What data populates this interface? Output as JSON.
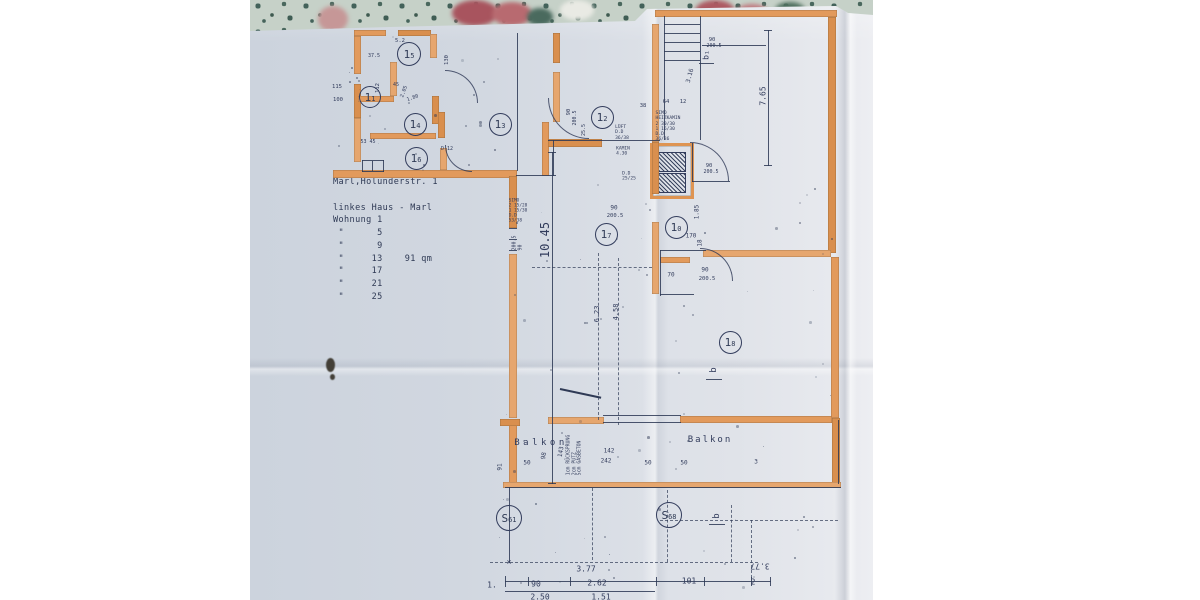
{
  "photo": {
    "description": "photo of an architectural floor plan on floral fabric",
    "address_block": "Marl,Holunderstr. 1\n\nlinkes Haus - Marl\nWohnung 1\n \"      5\n \"      9\n \"     13    91 qm\n \"     17\n \"     21\n \"     25",
    "badges": [
      {
        "m": "1",
        "s": "5",
        "x": 408,
        "y": 53,
        "d": 22
      },
      {
        "m": "1",
        "s": "1",
        "x": 369,
        "y": 96,
        "d": 20
      },
      {
        "m": "1",
        "s": "4",
        "x": 414,
        "y": 123,
        "d": 21
      },
      {
        "m": "1",
        "s": "3",
        "x": 499,
        "y": 123,
        "d": 21
      },
      {
        "m": "1",
        "s": "6",
        "x": 415,
        "y": 157,
        "d": 21
      },
      {
        "m": "1",
        "s": "2",
        "x": 601,
        "y": 116,
        "d": 21
      },
      {
        "m": "1",
        "s": "7",
        "x": 605,
        "y": 233,
        "d": 21
      },
      {
        "m": "1",
        "s": "0",
        "x": 675,
        "y": 226,
        "d": 21
      },
      {
        "m": "1",
        "s": "8",
        "x": 729,
        "y": 341,
        "d": 21
      },
      {
        "m": "S",
        "s": "61",
        "x": 508,
        "y": 517,
        "d": 24
      },
      {
        "m": "S",
        "s": "68",
        "x": 668,
        "y": 514,
        "d": 24
      }
    ],
    "labels": [
      {
        "t": "Balkon",
        "x": 541,
        "y": 443,
        "s": 9,
        "ls": 3.5
      },
      {
        "t": "Balkon",
        "x": 710,
        "y": 440,
        "s": 9,
        "ls": 2
      },
      {
        "t": "10.45",
        "x": 546,
        "y": 240,
        "r": -90,
        "s": 12
      },
      {
        "t": "6.23",
        "x": 597,
        "y": 314,
        "r": -90,
        "s": 7
      },
      {
        "t": "4.58",
        "x": 616,
        "y": 312,
        "r": -90,
        "s": 7
      },
      {
        "t": "7.65",
        "x": 763,
        "y": 96,
        "r": -90,
        "s": 8
      },
      {
        "t": "3.16",
        "x": 691,
        "y": 76,
        "r": -75,
        "s": 6
      },
      {
        "t": "3.77",
        "x": 586,
        "y": 569,
        "s": 8
      },
      {
        "t": "3.77",
        "x": 760,
        "y": 566,
        "r": 180,
        "s": 8
      },
      {
        "t": "1.",
        "x": 492,
        "y": 585,
        "s": 8
      },
      {
        "t": "90",
        "x": 536,
        "y": 584,
        "s": 8
      },
      {
        "t": "2.62",
        "x": 597,
        "y": 583,
        "s": 8
      },
      {
        "t": "101",
        "x": 689,
        "y": 581,
        "s": 8
      },
      {
        "t": "2",
        "x": 753,
        "y": 582,
        "s": 8
      },
      {
        "t": "2.50",
        "x": 540,
        "y": 597,
        "s": 8
      },
      {
        "t": "1.51",
        "x": 601,
        "y": 597,
        "s": 8
      },
      {
        "t": "×",
        "x": 509,
        "y": 562,
        "s": 8
      },
      {
        "t": "50",
        "x": 527,
        "y": 464,
        "s": 6
      },
      {
        "t": "91",
        "x": 501,
        "y": 467,
        "r": -90,
        "s": 6
      },
      {
        "t": "98",
        "x": 545,
        "y": 456,
        "r": -80,
        "s": 6
      },
      {
        "t": "143",
        "x": 562,
        "y": 452,
        "r": -80,
        "s": 6
      },
      {
        "t": "142",
        "x": 609,
        "y": 452,
        "s": 6
      },
      {
        "t": "242",
        "x": 606,
        "y": 462,
        "s": 6
      },
      {
        "t": "50",
        "x": 648,
        "y": 464,
        "s": 6
      },
      {
        "t": "50",
        "x": 684,
        "y": 464,
        "s": 6
      },
      {
        "t": "3",
        "x": 756,
        "y": 463,
        "s": 6
      },
      {
        "t": "90",
        "x": 614,
        "y": 209,
        "s": 6
      },
      {
        "t": "200.5",
        "x": 615,
        "y": 216,
        "s": 5.5
      },
      {
        "t": "70",
        "x": 671,
        "y": 276,
        "s": 6
      },
      {
        "t": "90",
        "x": 705,
        "y": 271,
        "s": 6
      },
      {
        "t": "200.5",
        "x": 707,
        "y": 279,
        "s": 5.5
      },
      {
        "t": "170",
        "x": 691,
        "y": 237,
        "s": 6
      },
      {
        "t": "1.85",
        "x": 698,
        "y": 212,
        "r": -90,
        "s": 6
      },
      {
        "t": "18",
        "x": 701,
        "y": 243,
        "r": -90,
        "s": 6
      },
      {
        "t": "90",
        "x": 709,
        "y": 166,
        "s": 5.5
      },
      {
        "t": "200.5",
        "x": 711,
        "y": 173,
        "s": 5
      },
      {
        "t": "90",
        "x": 712,
        "y": 40,
        "s": 5.5
      },
      {
        "t": "200.5",
        "x": 714,
        "y": 47,
        "s": 5
      },
      {
        "t": "64",
        "x": 666,
        "y": 102,
        "s": 5.5
      },
      {
        "t": "38",
        "x": 643,
        "y": 106,
        "s": 5.5
      },
      {
        "t": "12",
        "x": 683,
        "y": 102,
        "s": 5.5
      },
      {
        "t": "5.2",
        "x": 400,
        "y": 41,
        "s": 5.5
      },
      {
        "t": "130",
        "x": 447,
        "y": 60,
        "r": -90,
        "s": 5.5
      },
      {
        "t": "112",
        "x": 378,
        "y": 88,
        "r": -90,
        "s": 5.5
      },
      {
        "t": "115",
        "x": 337,
        "y": 87,
        "s": 5.5
      },
      {
        "t": "100",
        "x": 338,
        "y": 100,
        "s": 5.5
      },
      {
        "t": "37.5",
        "x": 374,
        "y": 57,
        "s": 5
      },
      {
        "t": "45",
        "x": 396,
        "y": 86,
        "s": 5
      },
      {
        "t": "2.05",
        "x": 405,
        "y": 92,
        "r": -70,
        "s": 5
      },
      {
        "t": "1.80",
        "x": 413,
        "y": 99,
        "r": -20,
        "s": 5
      },
      {
        "t": "53 45",
        "x": 368,
        "y": 143,
        "s": 5
      },
      {
        "t": "D 12",
        "x": 447,
        "y": 150,
        "s": 5
      },
      {
        "t": "90",
        "x": 569,
        "y": 112,
        "r": -90,
        "s": 5.5
      },
      {
        "t": "200.5",
        "x": 576,
        "y": 118,
        "r": -90,
        "s": 5
      },
      {
        "t": "25.5",
        "x": 585,
        "y": 130,
        "r": -90,
        "s": 5
      },
      {
        "t": "b₁",
        "x": 706,
        "y": 55,
        "r": -90,
        "s": 8
      },
      {
        "t": "b",
        "x": 714,
        "y": 370,
        "r": -90,
        "s": 9
      },
      {
        "t": "b",
        "x": 717,
        "y": 516,
        "r": -90,
        "s": 9
      },
      {
        "t": "SIMO\nHEIZKAMIN\n2 30/30\n1 16/30\nD.D\n36/36",
        "x": 668,
        "y": 127,
        "s": 4.6
      },
      {
        "t": "LÜFT\nD.D\n36/38",
        "x": 622,
        "y": 133,
        "s": 4.6
      },
      {
        "t": "KAMIN\n4.30",
        "x": 623,
        "y": 152,
        "s": 4.6
      },
      {
        "t": "D.D\n25/25",
        "x": 629,
        "y": 177,
        "s": 4.6
      },
      {
        "t": "SIMO\n2 15/28\n1 15/30\nD.D\n53/38",
        "x": 518,
        "y": 211,
        "s": 4.4
      },
      {
        "t": "200.5\n90",
        "x": 518,
        "y": 243,
        "r": -90,
        "s": 5
      },
      {
        "t": "1cm RÜCKSPRUNG\n2cm PUTZ\n5cm GASBETON",
        "x": 575,
        "y": 455,
        "r": -90,
        "s": 4.8
      }
    ],
    "colors": {
      "paper": "#d6dce4",
      "wall_highlight": "#e09a5f",
      "ink": "#2f3a55",
      "fabric": "#c6d1c8"
    }
  }
}
